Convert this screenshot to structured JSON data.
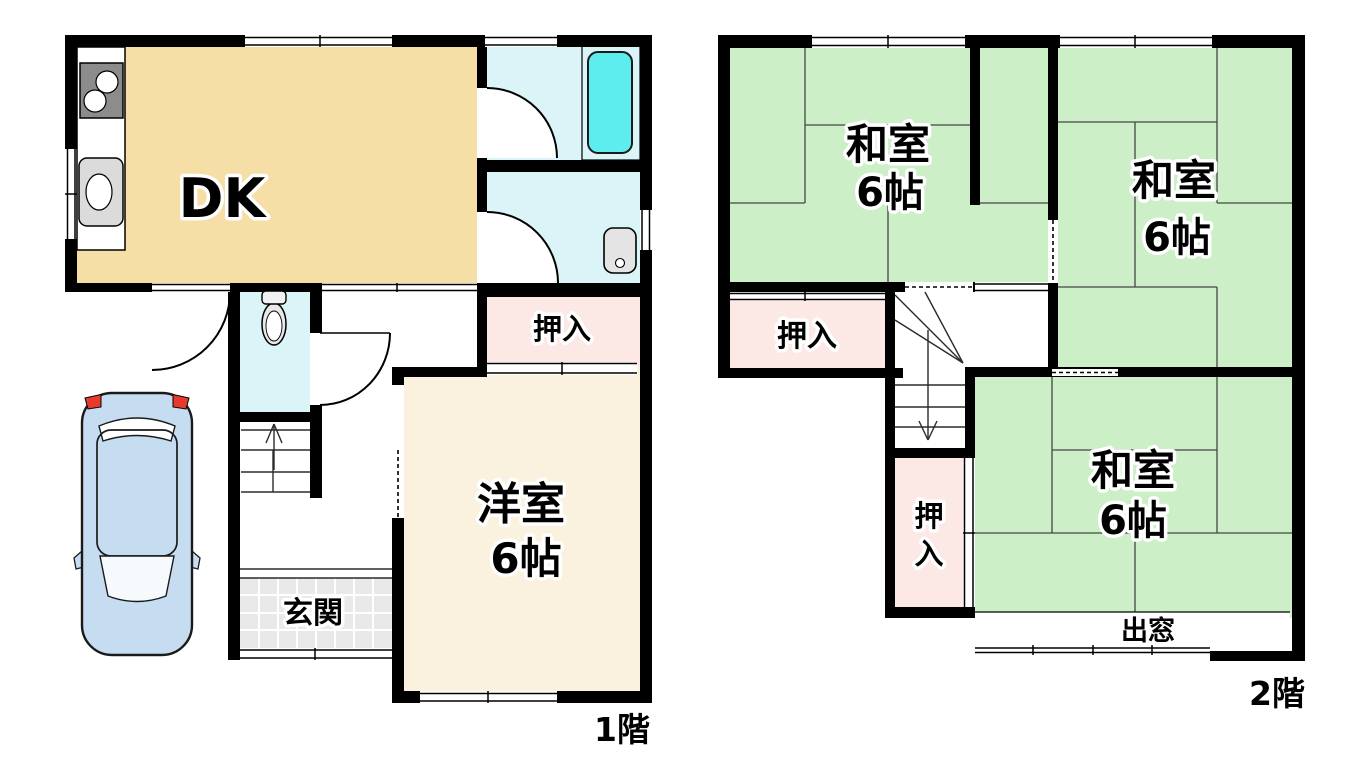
{
  "document": {
    "type": "floor-plan",
    "floors_shown": 2
  },
  "colors": {
    "wall": "#000000",
    "dk_floor": "#F5DFA6",
    "western_floor": "#FAF2DE",
    "tatami": "#CDEFC7",
    "wet": "#DBF4F7",
    "bathtub": "#5EEDEE",
    "closet": "#FCE9E6",
    "tile": "#E9E9E9",
    "car_body": "#C6DCF0",
    "tail_light": "#E8392E"
  },
  "floor1": {
    "floor_label": "1階",
    "rooms": {
      "dk": {
        "label": "DK"
      },
      "western": {
        "label": "洋室",
        "size": "6帖"
      },
      "closet": {
        "label": "押入"
      },
      "entrance": {
        "label": "玄関"
      }
    }
  },
  "floor2": {
    "floor_label": "2階",
    "rooms": {
      "tatami_nw": {
        "label": "和室",
        "size": "6帖"
      },
      "tatami_ne": {
        "label": "和室",
        "size": "6帖"
      },
      "tatami_s": {
        "label": "和室",
        "size": "6帖"
      },
      "closet_n": {
        "label": "押入"
      },
      "closet_w": {
        "label": "押入",
        "char1": "押",
        "char2": "入"
      },
      "bay_window": {
        "label": "出窓"
      }
    }
  },
  "fixtures": {
    "stove": "gas-stove-icon",
    "sink": "kitchen-sink-icon",
    "bathtub": "bathtub-icon",
    "toilet": "toilet-icon",
    "washbasin": "wash-basin-icon",
    "stairs_up": "stairs-up-arrow-icon",
    "stairs_down": "stairs-down-arrow-icon",
    "car": "car-top-view-icon"
  }
}
